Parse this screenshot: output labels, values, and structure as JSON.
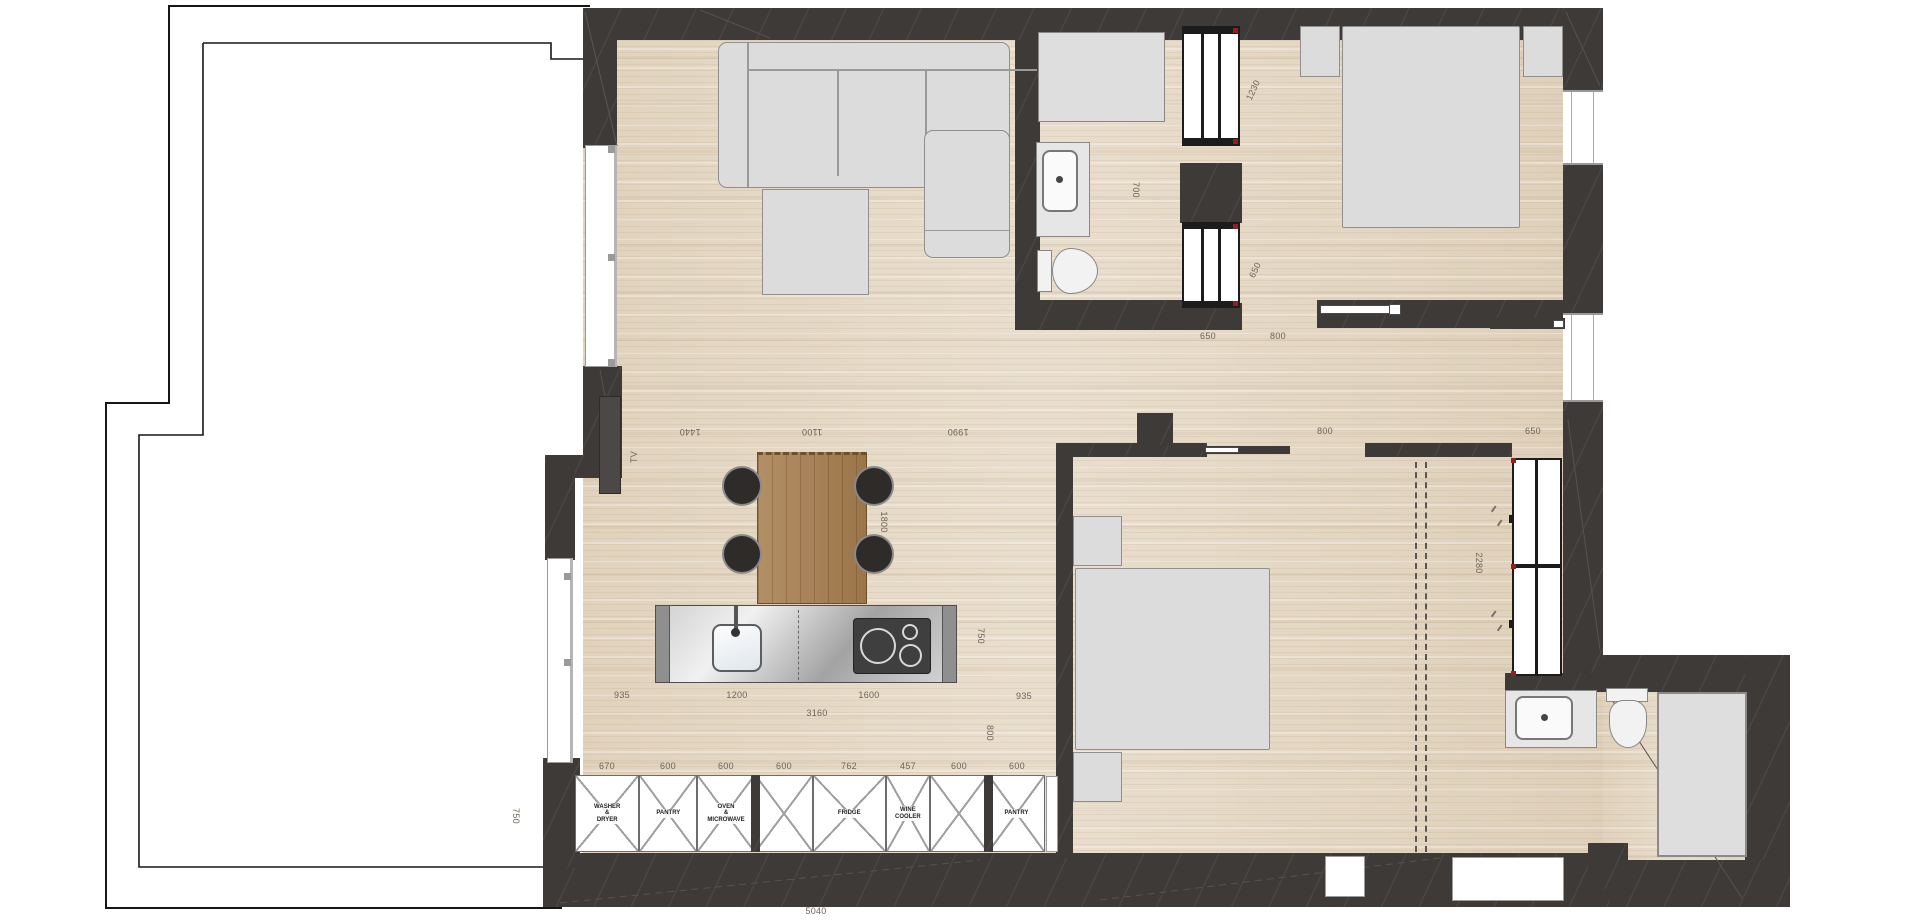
{
  "plan": {
    "type": "apartment-floor-plan",
    "colors": {
      "wall": "#3e3a38",
      "floor_wood": "#e6dac7",
      "furniture_gray": "#dcdcdc",
      "island_steel": "#c9c9c9",
      "table_wood": "#a87f50",
      "accent_red": "#9b1c20",
      "dimension_text": "#6e6456"
    }
  },
  "annotations": [
    {
      "text": "1440",
      "x": 690,
      "y": 432,
      "rot": 180
    },
    {
      "text": "1100",
      "x": 812,
      "y": 432,
      "rot": 180
    },
    {
      "text": "1990",
      "x": 958,
      "y": 432,
      "rot": 180
    },
    {
      "text": "800",
      "x": 1325,
      "y": 431,
      "rot": 0
    },
    {
      "text": "650",
      "x": 1533,
      "y": 431,
      "rot": 0
    },
    {
      "text": "935",
      "x": 622,
      "y": 695,
      "rot": 0
    },
    {
      "text": "1200",
      "x": 737,
      "y": 695,
      "rot": 0
    },
    {
      "text": "1600",
      "x": 869,
      "y": 695,
      "rot": 0
    },
    {
      "text": "935",
      "x": 1024,
      "y": 696,
      "rot": 0
    },
    {
      "text": "3160",
      "x": 817,
      "y": 713,
      "rot": 0
    },
    {
      "text": "750",
      "x": 981,
      "y": 636,
      "rot": 90
    },
    {
      "text": "800",
      "x": 990,
      "y": 733,
      "rot": 90
    },
    {
      "text": "1800",
      "x": 884,
      "y": 522,
      "rot": 90
    },
    {
      "text": "TV",
      "x": 634,
      "y": 457,
      "rot": -90
    },
    {
      "text": "700",
      "x": 1136,
      "y": 190,
      "rot": 90
    },
    {
      "text": "1230",
      "x": 1253,
      "y": 90,
      "rot": -65
    },
    {
      "text": "650",
      "x": 1255,
      "y": 270,
      "rot": -65
    },
    {
      "text": "2280",
      "x": 1479,
      "y": 563,
      "rot": 90
    },
    {
      "text": "650",
      "x": 1208,
      "y": 336,
      "rot": 0
    },
    {
      "text": "800",
      "x": 1278,
      "y": 336,
      "rot": 0
    },
    {
      "text": "750",
      "x": 516,
      "y": 816,
      "rot": 90
    },
    {
      "text": "5040",
      "x": 816,
      "y": 911,
      "rot": 0
    },
    {
      "text": "670",
      "x": 607,
      "y": 766,
      "rot": 0
    },
    {
      "text": "600",
      "x": 668,
      "y": 766,
      "rot": 0
    },
    {
      "text": "600",
      "x": 726,
      "y": 766,
      "rot": 0
    },
    {
      "text": "600",
      "x": 784,
      "y": 766,
      "rot": 0
    },
    {
      "text": "762",
      "x": 849,
      "y": 766,
      "rot": 0
    },
    {
      "text": "457",
      "x": 908,
      "y": 766,
      "rot": 0
    },
    {
      "text": "600",
      "x": 959,
      "y": 766,
      "rot": 0
    },
    {
      "text": "600",
      "x": 1017,
      "y": 766,
      "rot": 0
    }
  ],
  "cabinets": {
    "scale_px_per_mm": 0.0962,
    "origin_x": 575,
    "y": 775,
    "height": 77,
    "items": [
      {
        "label": "WASHER\n&\nDRYER",
        "dim": 670
      },
      {
        "label": "PANTRY",
        "dim": 600
      },
      {
        "label": "OVEN\n&\nMICROWAVE",
        "dim": 600
      },
      {
        "label": "",
        "dim": 600
      },
      {
        "label": "FRIDGE",
        "dim": 762
      },
      {
        "label": "WINE\nCOOLER",
        "dim": 457
      },
      {
        "label": "",
        "dim": 600
      },
      {
        "label": "PANTRY",
        "dim": 600
      }
    ],
    "separators_after": [
      2,
      6
    ]
  }
}
